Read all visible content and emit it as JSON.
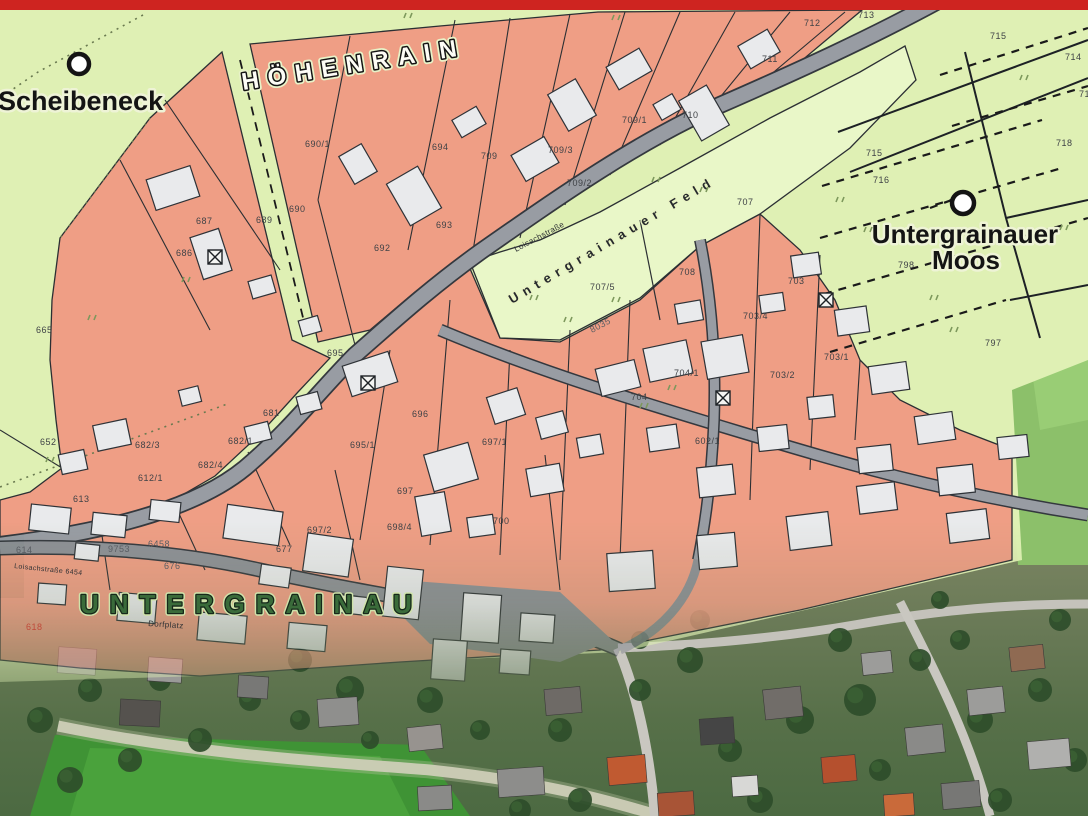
{
  "map": {
    "top_bar_color": "#ce2420",
    "colors": {
      "field_green": "#dff0b4",
      "feld_light_green": "#e9f7c8",
      "parcel_salmon": "#ef9e85",
      "road_gray": "#989ca3",
      "road_casing": "#3a3e44",
      "building_fill": "#e9eaec",
      "building_stroke": "#2e3237",
      "boundary_line": "#2b2f33",
      "aerial_grass": "#4a9a3a",
      "aerial_tree": "#2e4d2a",
      "label_green": "#2f5c31"
    },
    "place_labels": [
      {
        "id": "scheibeneck",
        "text": "Scheibeneck",
        "x": -2,
        "y": 110,
        "size": 27,
        "rotate": 0,
        "style": "bold-halo"
      },
      {
        "id": "hoehenrain",
        "text": "HÖHENRAIN",
        "x": 243,
        "y": 90,
        "size": 24,
        "rotate": -9,
        "style": "outline-spaced",
        "spacing": 9
      },
      {
        "id": "untergrainauer-moos-1",
        "text": "Untergrainauer",
        "x": 965,
        "y": 243,
        "size": 26,
        "rotate": 0,
        "style": "bold-halo-center"
      },
      {
        "id": "untergrainauer-moos-2",
        "text": "Moos",
        "x": 966,
        "y": 269,
        "size": 26,
        "rotate": 0,
        "style": "bold-halo-center"
      },
      {
        "id": "untergrainau",
        "text": "UNTERGRAINAU",
        "x": 80,
        "y": 613,
        "size": 26,
        "rotate": 0,
        "style": "green-outline-spaced",
        "spacing": 11
      },
      {
        "id": "untergrainauer-feld",
        "text": "Untergrainauer Feld",
        "x": 512,
        "y": 304,
        "size": 13,
        "rotate": -30.5,
        "style": "dark-spaced",
        "spacing": 6
      }
    ],
    "road_labels": [
      {
        "id": "loisachstrasse",
        "text": "Loisachstraße",
        "x": 516,
        "y": 252,
        "size": 8,
        "rotate": -28
      },
      {
        "id": "loisachstrasse-2",
        "text": "Loisachstraße 6454",
        "x": 14,
        "y": 568,
        "size": 7,
        "rotate": 6
      },
      {
        "id": "dorfplatz",
        "text": "Dorfplatz",
        "x": 148,
        "y": 626,
        "size": 8,
        "rotate": 4
      }
    ],
    "map_markers": [
      {
        "id": "scheibeneck-marker",
        "x": 79,
        "y": 64,
        "r": 10
      },
      {
        "id": "moos-marker",
        "x": 963,
        "y": 203,
        "r": 11
      }
    ],
    "special_symbols": [
      {
        "id": "crossed-square-1",
        "x": 215,
        "y": 257
      },
      {
        "id": "crossed-square-2",
        "x": 368,
        "y": 383
      },
      {
        "id": "crossed-square-3",
        "x": 723,
        "y": 398
      },
      {
        "id": "crossed-square-4",
        "x": 826,
        "y": 300
      }
    ],
    "parcel_numbers": [
      {
        "t": "665",
        "x": 36,
        "y": 333
      },
      {
        "t": "652",
        "x": 40,
        "y": 445
      },
      {
        "t": "682/3",
        "x": 135,
        "y": 448
      },
      {
        "t": "682/4",
        "x": 198,
        "y": 468
      },
      {
        "t": "682/1",
        "x": 228,
        "y": 444
      },
      {
        "t": "681",
        "x": 263,
        "y": 416
      },
      {
        "t": "686",
        "x": 176,
        "y": 256
      },
      {
        "t": "687",
        "x": 196,
        "y": 224
      },
      {
        "t": "689",
        "x": 256,
        "y": 223
      },
      {
        "t": "690",
        "x": 289,
        "y": 212
      },
      {
        "t": "690/1",
        "x": 305,
        "y": 147
      },
      {
        "t": "692",
        "x": 374,
        "y": 251
      },
      {
        "t": "693",
        "x": 436,
        "y": 228
      },
      {
        "t": "694",
        "x": 432,
        "y": 150
      },
      {
        "t": "709",
        "x": 481,
        "y": 159
      },
      {
        "t": "709/3",
        "x": 548,
        "y": 153
      },
      {
        "t": "709/2",
        "x": 567,
        "y": 186
      },
      {
        "t": "709/1",
        "x": 622,
        "y": 123
      },
      {
        "t": "710",
        "x": 682,
        "y": 118
      },
      {
        "t": "711",
        "x": 762,
        "y": 62
      },
      {
        "t": "712",
        "x": 804,
        "y": 26
      },
      {
        "t": "713",
        "x": 858,
        "y": 18
      },
      {
        "t": "715",
        "x": 990,
        "y": 39
      },
      {
        "t": "714",
        "x": 1065,
        "y": 60
      },
      {
        "t": "719",
        "x": 1079,
        "y": 97
      },
      {
        "t": "718",
        "x": 1056,
        "y": 146
      },
      {
        "t": "715",
        "x": 866,
        "y": 156
      },
      {
        "t": "716",
        "x": 873,
        "y": 183
      },
      {
        "t": "798",
        "x": 898,
        "y": 268
      },
      {
        "t": "797",
        "x": 985,
        "y": 346
      },
      {
        "t": "707",
        "x": 737,
        "y": 205
      },
      {
        "t": "707/5",
        "x": 590,
        "y": 290
      },
      {
        "t": "708",
        "x": 679,
        "y": 275
      },
      {
        "t": "8035",
        "x": 592,
        "y": 333,
        "r": -28,
        "c": "#5a5e63"
      },
      {
        "t": "695",
        "x": 327,
        "y": 356
      },
      {
        "t": "695/1",
        "x": 350,
        "y": 448
      },
      {
        "t": "696",
        "x": 412,
        "y": 417
      },
      {
        "t": "697",
        "x": 397,
        "y": 494
      },
      {
        "t": "697/1",
        "x": 482,
        "y": 445
      },
      {
        "t": "697/2",
        "x": 307,
        "y": 533
      },
      {
        "t": "698/4",
        "x": 387,
        "y": 530
      },
      {
        "t": "677",
        "x": 276,
        "y": 552
      },
      {
        "t": "700",
        "x": 493,
        "y": 524
      },
      {
        "t": "704/1",
        "x": 674,
        "y": 376
      },
      {
        "t": "704",
        "x": 631,
        "y": 400
      },
      {
        "t": "703/4",
        "x": 743,
        "y": 319
      },
      {
        "t": "703",
        "x": 788,
        "y": 284
      },
      {
        "t": "703/1",
        "x": 824,
        "y": 360
      },
      {
        "t": "703/2",
        "x": 770,
        "y": 378
      },
      {
        "t": "602/1",
        "x": 695,
        "y": 444
      },
      {
        "t": "612/1",
        "x": 138,
        "y": 481
      },
      {
        "t": "613",
        "x": 73,
        "y": 502
      },
      {
        "t": "614",
        "x": 16,
        "y": 553,
        "c": "#5a5e63"
      },
      {
        "t": "676",
        "x": 164,
        "y": 569,
        "c": "#5a5e63"
      },
      {
        "t": "618",
        "x": 26,
        "y": 630,
        "c": "#c04a3a"
      },
      {
        "t": "9753",
        "x": 108,
        "y": 552,
        "c": "#5a5e63"
      },
      {
        "t": "6458",
        "x": 148,
        "y": 547,
        "c": "#5a5e63"
      }
    ],
    "vegetation_marks": [
      [
        404,
        18
      ],
      [
        612,
        20
      ],
      [
        836,
        202
      ],
      [
        864,
        232
      ],
      [
        950,
        332
      ],
      [
        652,
        182
      ],
      [
        700,
        192
      ],
      [
        564,
        322
      ],
      [
        182,
        282
      ],
      [
        46,
        462
      ],
      [
        88,
        320
      ],
      [
        1020,
        80
      ],
      [
        1060,
        230
      ],
      [
        930,
        300
      ],
      [
        530,
        300
      ],
      [
        612,
        302
      ],
      [
        668,
        390
      ],
      [
        640,
        408
      ]
    ],
    "map_features": {
      "buildings_cadastral": [
        [
          150,
          172,
          46,
          32,
          -18
        ],
        [
          196,
          232,
          30,
          44,
          -18
        ],
        [
          250,
          278,
          24,
          18,
          -16
        ],
        [
          300,
          318,
          20,
          16,
          -16
        ],
        [
          345,
          148,
          26,
          32,
          -30
        ],
        [
          396,
          172,
          36,
          48,
          -30
        ],
        [
          455,
          112,
          28,
          20,
          -30
        ],
        [
          516,
          144,
          38,
          30,
          -30
        ],
        [
          556,
          84,
          32,
          42,
          -30
        ],
        [
          610,
          56,
          38,
          26,
          -30
        ],
        [
          656,
          98,
          22,
          18,
          -30
        ],
        [
          688,
          90,
          32,
          46,
          -30
        ],
        [
          742,
          36,
          34,
          26,
          -30
        ],
        [
          60,
          452,
          26,
          20,
          -12
        ],
        [
          95,
          422,
          34,
          26,
          -12
        ],
        [
          346,
          358,
          48,
          32,
          -18
        ],
        [
          298,
          394,
          22,
          18,
          -15
        ],
        [
          428,
          448,
          46,
          38,
          -16
        ],
        [
          490,
          392,
          32,
          28,
          -18
        ],
        [
          538,
          414,
          28,
          22,
          -15
        ],
        [
          598,
          364,
          40,
          28,
          -14
        ],
        [
          646,
          344,
          44,
          34,
          -12
        ],
        [
          676,
          302,
          26,
          20,
          -10
        ],
        [
          704,
          338,
          42,
          38,
          -10
        ],
        [
          760,
          294,
          24,
          18,
          -8
        ],
        [
          792,
          254,
          28,
          22,
          -8
        ],
        [
          836,
          308,
          32,
          26,
          -8
        ],
        [
          870,
          364,
          38,
          28,
          -8
        ],
        [
          916,
          414,
          38,
          28,
          -8
        ],
        [
          246,
          424,
          24,
          18,
          -14
        ],
        [
          180,
          388,
          20,
          16,
          -14
        ],
        [
          418,
          494,
          30,
          40,
          -10
        ],
        [
          468,
          516,
          26,
          20,
          -8
        ],
        [
          528,
          466,
          34,
          28,
          -10
        ],
        [
          578,
          436,
          24,
          20,
          -10
        ],
        [
          648,
          426,
          30,
          24,
          -8
        ],
        [
          698,
          466,
          36,
          30,
          -6
        ],
        [
          758,
          426,
          30,
          24,
          -6
        ],
        [
          808,
          396,
          26,
          22,
          -6
        ],
        [
          858,
          446,
          34,
          26,
          -6
        ],
        [
          938,
          466,
          36,
          28,
          -6
        ],
        [
          998,
          436,
          30,
          22,
          -6
        ],
        [
          30,
          506,
          40,
          26,
          6
        ],
        [
          92,
          514,
          34,
          22,
          6
        ],
        [
          150,
          501,
          30,
          20,
          6
        ],
        [
          225,
          508,
          56,
          34,
          8
        ],
        [
          305,
          536,
          46,
          38,
          8
        ],
        [
          385,
          568,
          36,
          50,
          6
        ],
        [
          38,
          584,
          28,
          20,
          4
        ],
        [
          118,
          594,
          38,
          28,
          5
        ],
        [
          198,
          614,
          48,
          28,
          5
        ],
        [
          288,
          624,
          38,
          26,
          5
        ],
        [
          462,
          594,
          38,
          48,
          4
        ],
        [
          520,
          614,
          34,
          28,
          4
        ],
        [
          608,
          552,
          46,
          38,
          -4
        ],
        [
          698,
          534,
          38,
          34,
          -5
        ],
        [
          788,
          514,
          42,
          34,
          -7
        ],
        [
          858,
          484,
          38,
          28,
          -7
        ],
        [
          948,
          511,
          40,
          30,
          -7
        ],
        [
          75,
          544,
          24,
          16,
          6
        ],
        [
          260,
          566,
          30,
          20,
          8
        ],
        [
          340,
          596,
          26,
          18,
          6
        ],
        [
          432,
          640,
          34,
          40,
          4
        ],
        [
          500,
          650,
          30,
          24,
          4
        ]
      ],
      "buildings_aerial": [
        [
          318,
          698,
          40,
          28,
          -4,
          "#8f8f8d"
        ],
        [
          408,
          726,
          34,
          24,
          -6,
          "#97938f"
        ],
        [
          545,
          688,
          36,
          26,
          -5,
          "#6e6a66"
        ],
        [
          608,
          756,
          38,
          28,
          -5,
          "#c05a31"
        ],
        [
          700,
          718,
          34,
          26,
          -4,
          "#454545"
        ],
        [
          764,
          688,
          38,
          30,
          -6,
          "#716d69"
        ],
        [
          822,
          756,
          34,
          26,
          -5,
          "#b5502e"
        ],
        [
          906,
          726,
          38,
          28,
          -6,
          "#8a8a88"
        ],
        [
          968,
          688,
          36,
          26,
          -6,
          "#9c9c9a"
        ],
        [
          1028,
          740,
          42,
          28,
          -5,
          "#b0b0ae"
        ],
        [
          148,
          658,
          34,
          24,
          4,
          "#9a9a98"
        ],
        [
          58,
          648,
          38,
          26,
          4,
          "#8a8a88"
        ],
        [
          238,
          676,
          30,
          22,
          4,
          "#787876"
        ],
        [
          498,
          768,
          46,
          28,
          -4,
          "#8d8d8b"
        ],
        [
          658,
          792,
          36,
          24,
          -4,
          "#a85436"
        ],
        [
          942,
          782,
          38,
          26,
          -5,
          "#777775"
        ],
        [
          1010,
          646,
          34,
          24,
          -6,
          "#8f6a52"
        ],
        [
          862,
          652,
          30,
          22,
          -6,
          "#9c9c9a"
        ],
        [
          418,
          786,
          34,
          24,
          -3,
          "#8a8a88"
        ],
        [
          120,
          700,
          40,
          26,
          3,
          "#55524e"
        ],
        [
          732,
          776,
          26,
          20,
          -4,
          "#d8d8d6"
        ],
        [
          884,
          794,
          30,
          22,
          -4,
          "#c96a3a"
        ]
      ],
      "trees": [
        [
          300,
          660,
          12
        ],
        [
          350,
          690,
          14
        ],
        [
          250,
          700,
          11
        ],
        [
          430,
          700,
          13
        ],
        [
          480,
          730,
          10
        ],
        [
          560,
          730,
          12
        ],
        [
          640,
          690,
          11
        ],
        [
          690,
          660,
          13
        ],
        [
          730,
          750,
          12
        ],
        [
          800,
          720,
          14
        ],
        [
          860,
          700,
          16
        ],
        [
          840,
          640,
          12
        ],
        [
          920,
          660,
          11
        ],
        [
          980,
          720,
          13
        ],
        [
          1040,
          690,
          12
        ],
        [
          160,
          680,
          11
        ],
        [
          90,
          690,
          12
        ],
        [
          40,
          720,
          13
        ],
        [
          200,
          740,
          12
        ],
        [
          520,
          810,
          11
        ],
        [
          580,
          800,
          12
        ],
        [
          760,
          800,
          13
        ],
        [
          880,
          770,
          11
        ],
        [
          1000,
          800,
          12
        ],
        [
          700,
          620,
          10
        ],
        [
          640,
          640,
          9
        ],
        [
          960,
          640,
          10
        ],
        [
          1060,
          620,
          11
        ],
        [
          130,
          760,
          12
        ],
        [
          70,
          780,
          13
        ],
        [
          300,
          720,
          10
        ],
        [
          370,
          740,
          9
        ],
        [
          940,
          600,
          9
        ],
        [
          1075,
          760,
          12
        ]
      ]
    }
  }
}
